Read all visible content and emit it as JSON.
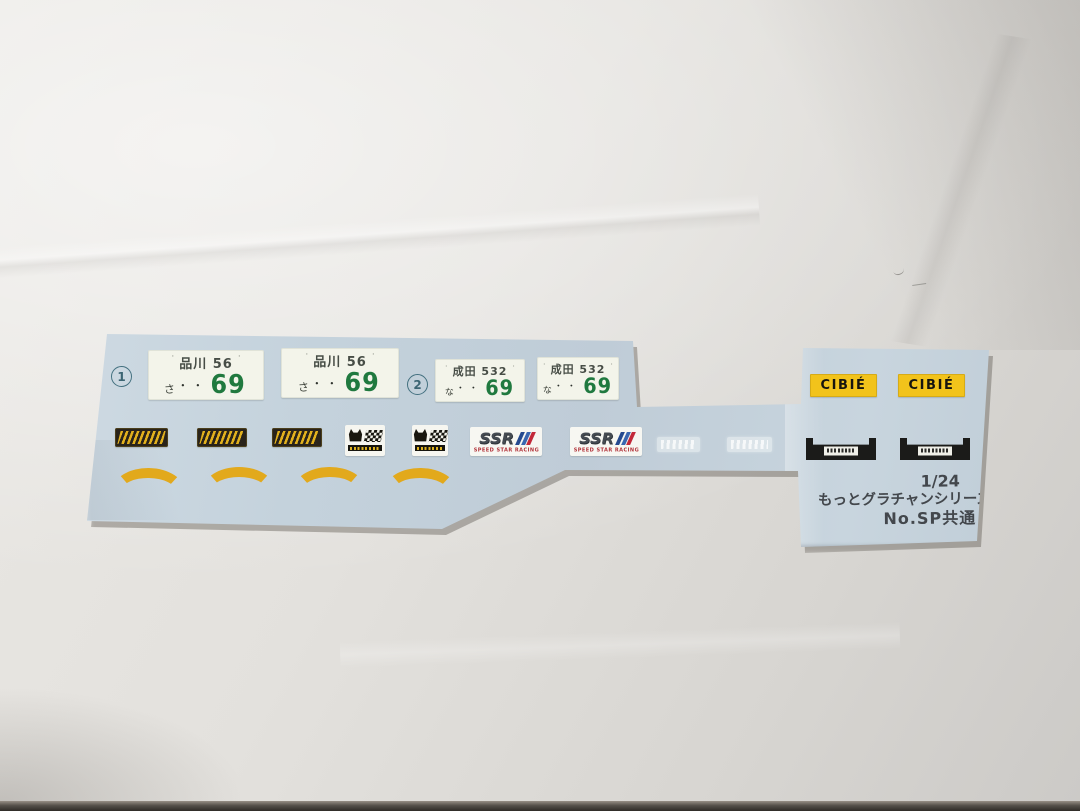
{
  "meta": {
    "description": "Photograph of a pale-blue water-slide decal sheet for a 1/24 scale Japanese model car kit, lying on slightly creased white paper",
    "sheet_shape": "wide left block joined by a narrow strip to a taller right block"
  },
  "colors": {
    "paper": "#e2e0dc",
    "sheet": "#c4d1db",
    "plate_bg": "#f3f4ea",
    "plate_green": "#20793f",
    "cibie_yellow": "#f2c31b",
    "arc_yellow": "#e2a91c",
    "ink": "#43474c"
  },
  "markers": [
    {
      "label": "1"
    },
    {
      "label": "2"
    }
  ],
  "plates": [
    {
      "bolt": "·",
      "region": "品川 56",
      "kana": "さ",
      "dots": "・・",
      "number": "69"
    },
    {
      "bolt": "·",
      "region": "品川 56",
      "kana": "さ",
      "dots": "・・",
      "number": "69"
    },
    {
      "bolt": "·",
      "region": "成田 532",
      "kana": "な",
      "dots": "・・",
      "number": "69"
    },
    {
      "bolt": "·",
      "region": "成田 532",
      "kana": "な",
      "dots": "・・",
      "number": "69"
    }
  ],
  "logos": {
    "stylized_yellow": {
      "count": 3,
      "description": "small black rectangle decal with stylized yellow script lettering (illegible in photo)"
    },
    "cat_flag": {
      "count": 2,
      "description": "white decal with black cat head beside a checkered racing flag over a black bar of tiny yellow text (illegible)"
    },
    "ssr": {
      "count": 2,
      "name": "SSR",
      "subtext": "SPEED STAR RACING"
    },
    "faint_clear": {
      "count": 2,
      "description": "two nearly invisible white clear-film logos printed on the backing"
    },
    "cibie": {
      "count": 2,
      "name": "CIBIÉ"
    },
    "garnish": {
      "count": 2,
      "description": "black number-plate garnish strip with a small white maker label of tiny text (illegible)"
    }
  },
  "arcs": {
    "count": 4,
    "description": "yellow curved fender accent stripes"
  },
  "footer": {
    "scale": "1/24",
    "series": "もっとグラチャンシリーズ",
    "common": "No.SP共通"
  }
}
